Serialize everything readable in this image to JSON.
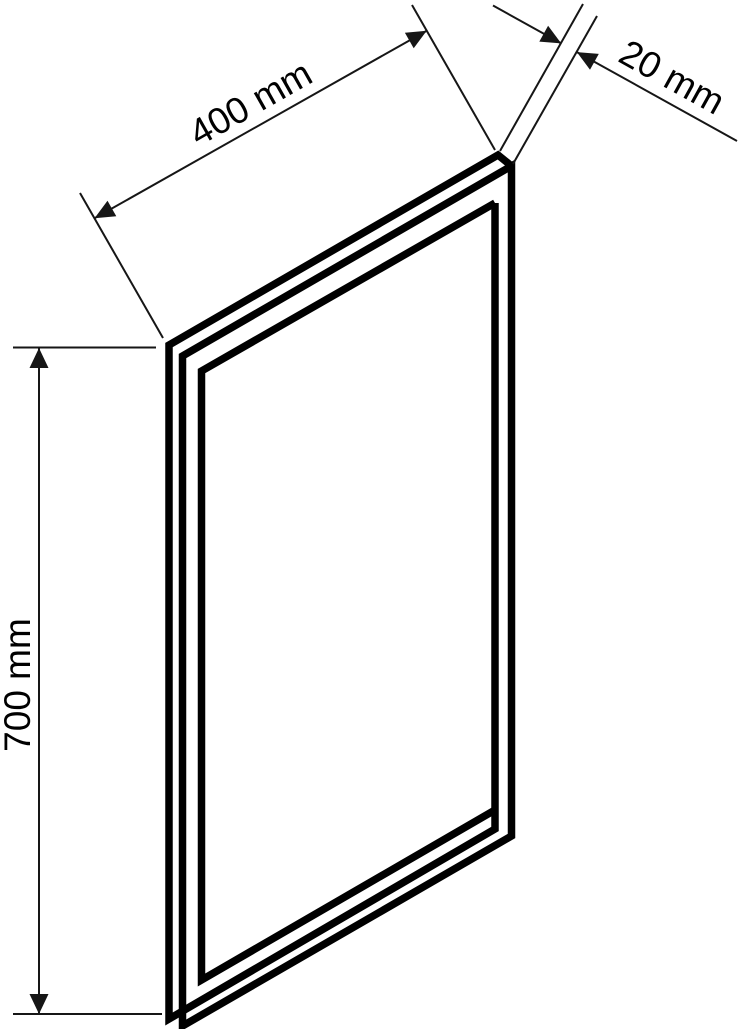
{
  "drawing": {
    "subject": "mirror-panel-dimension-drawing",
    "labels": {
      "width": "400 mm",
      "depth": "20 mm",
      "height": "700 mm"
    },
    "colors": {
      "line": "#000000",
      "dimension_line": "#161616",
      "background": "#ffffff"
    }
  }
}
